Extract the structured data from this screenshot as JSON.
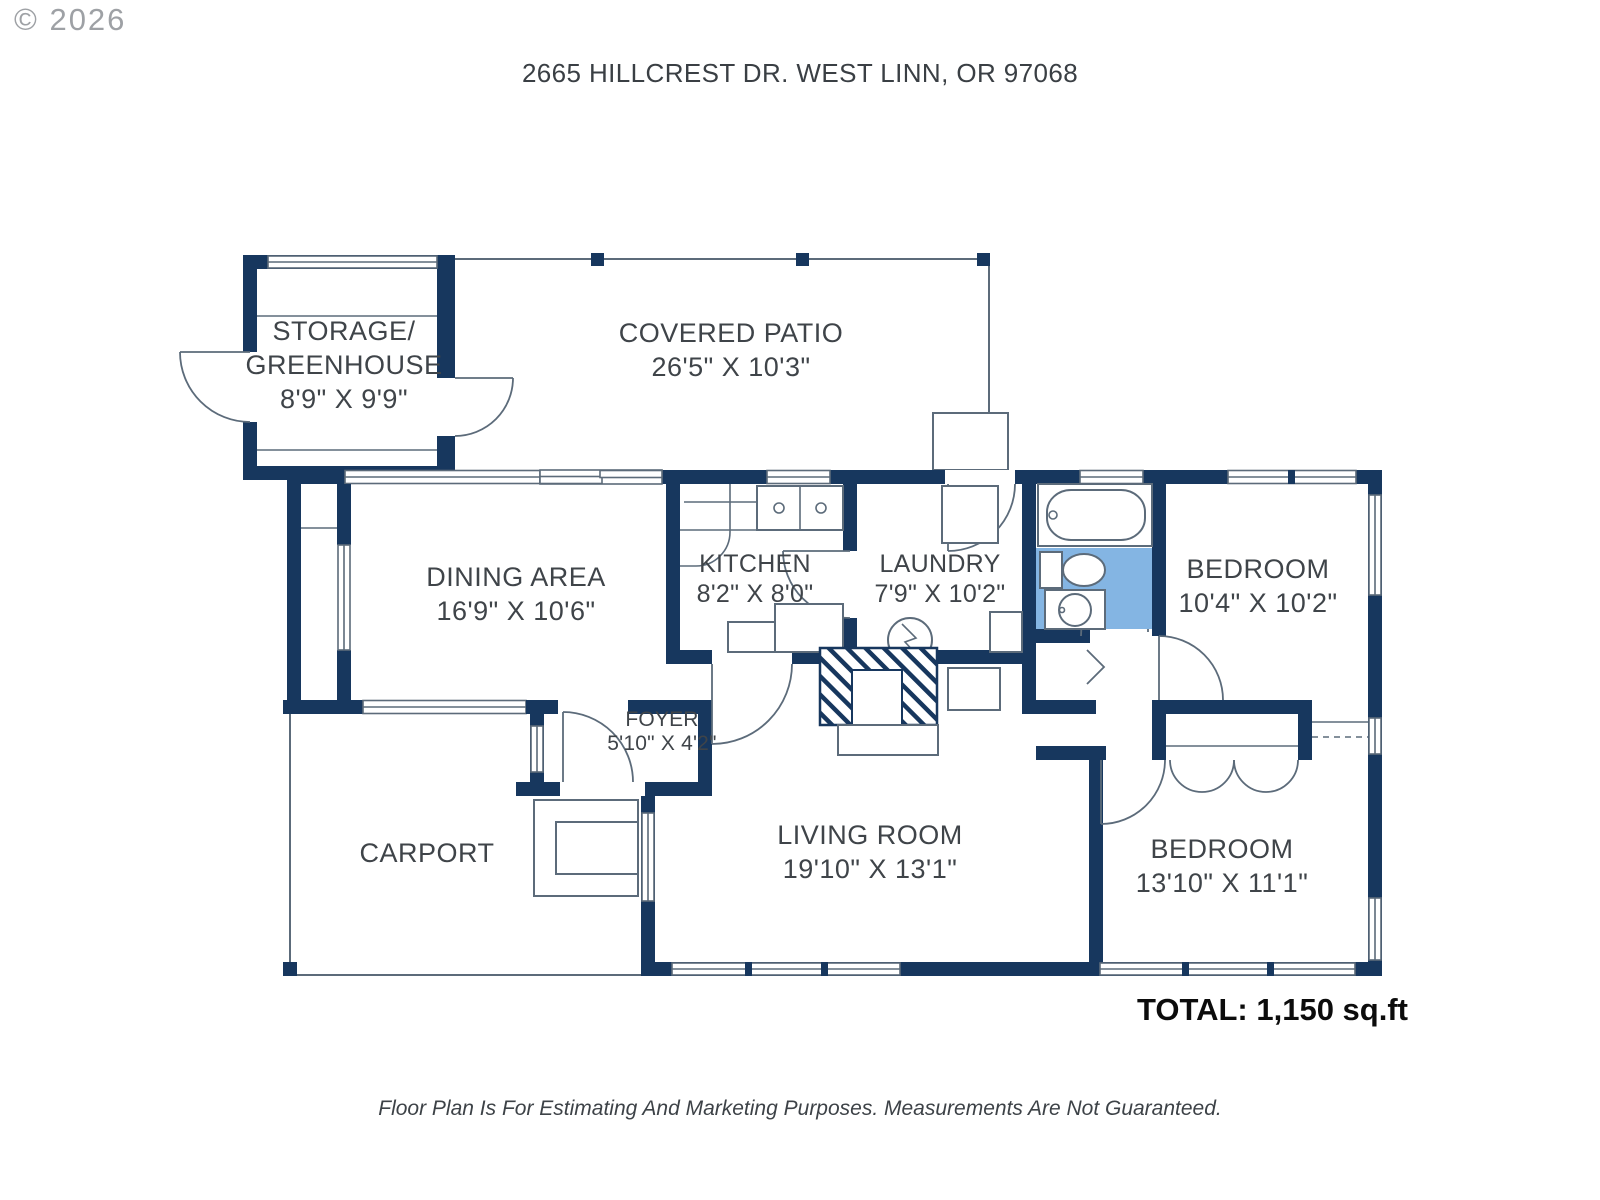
{
  "copyright": "© 2026",
  "header": {
    "title": "2665 HILLCREST DR. WEST LINN, OR 97068"
  },
  "rooms": {
    "storage": {
      "name1": "STORAGE/",
      "name2": "GREENHOUSE",
      "dims": "8'9\" X 9'9\""
    },
    "patio": {
      "name": "COVERED PATIO",
      "dims": "26'5\" X 10'3\""
    },
    "dining": {
      "name": "DINING AREA",
      "dims": "16'9\" X 10'6\""
    },
    "kitchen": {
      "name": "KITCHEN",
      "dims": "8'2\" X 8'0\""
    },
    "laundry": {
      "name": "LAUNDRY",
      "dims": "7'9\" X 10'2\""
    },
    "bedroom1": {
      "name": "BEDROOM",
      "dims": "10'4\" X 10'2\""
    },
    "foyer": {
      "name": "FOYER",
      "dims": "5'10\" X 4'2\""
    },
    "carport": {
      "name": "CARPORT"
    },
    "living": {
      "name": "LIVING ROOM",
      "dims": "19'10\" X 13'1\""
    },
    "bedroom2": {
      "name": "BEDROOM",
      "dims": "13'10\" X 11'1\""
    }
  },
  "footer": {
    "total": "TOTAL: 1,150 sq.ft",
    "disclaimer": "Floor Plan Is For Estimating And Marketing Purposes. Measurements Are Not Guaranteed."
  },
  "colors": {
    "wall": "#17375e",
    "line": "#5c6b7a",
    "bath_floor": "#84b5e3",
    "label": "#3f4449"
  }
}
